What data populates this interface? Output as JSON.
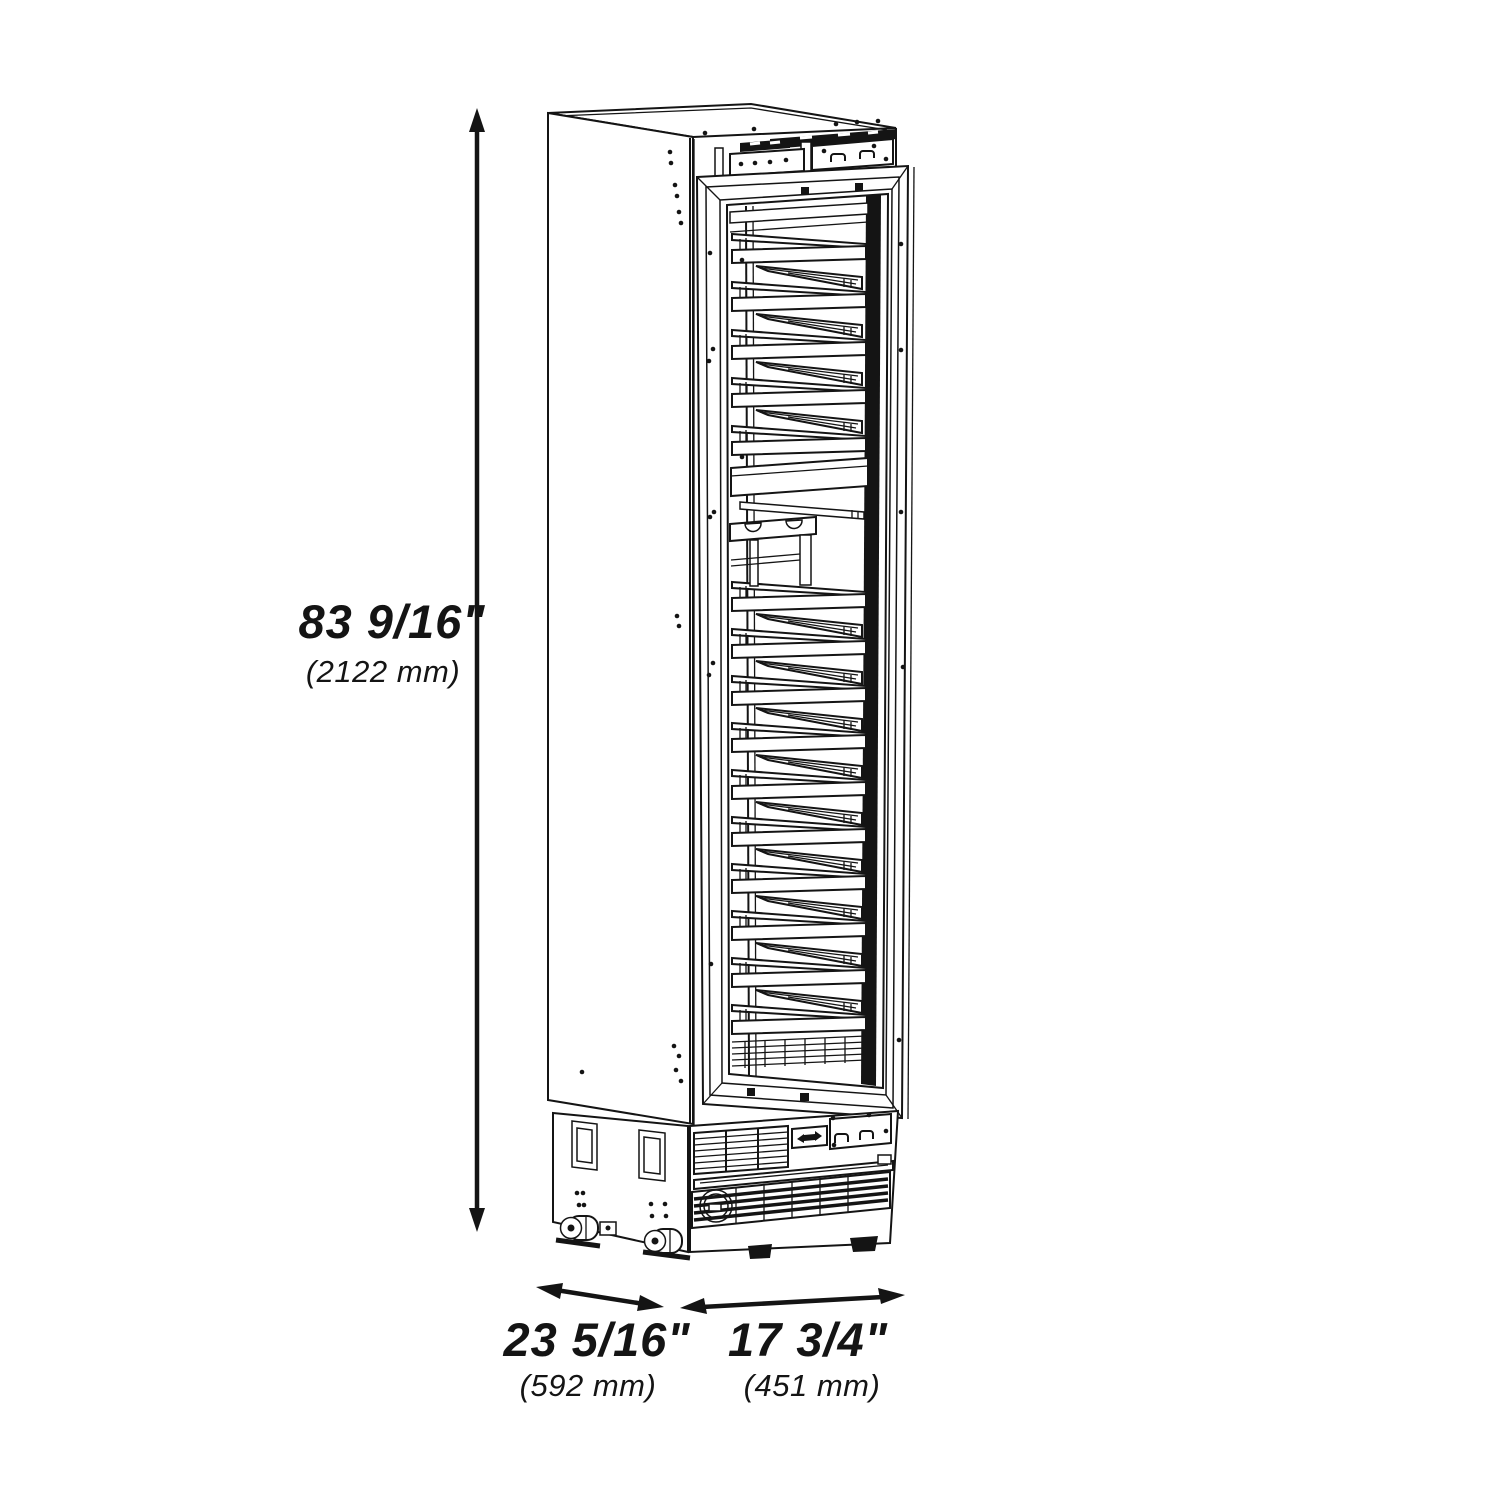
{
  "page": {
    "background": "#ffffff",
    "line_color": "#141414"
  },
  "diagram": {
    "type": "isometric-line-drawing",
    "subject": "tall single-column wine cooler with glass door, slide-out display racks, casters and front vent grilles",
    "dimensions": {
      "height": {
        "inches": "83 9/16\"",
        "mm": "(2122 mm)"
      },
      "depth": {
        "inches": "23 5/16\"",
        "mm": "(592 mm)"
      },
      "width": {
        "inches": "17 3/4\"",
        "mm": "(451 mm)"
      }
    },
    "cabinet": {
      "upper_shelf_count": 5,
      "lower_shelf_count": 10,
      "has_display_stand": true,
      "has_solid_display_shelf": true,
      "caster_count": 2,
      "leveling_feet_count": 2
    }
  }
}
